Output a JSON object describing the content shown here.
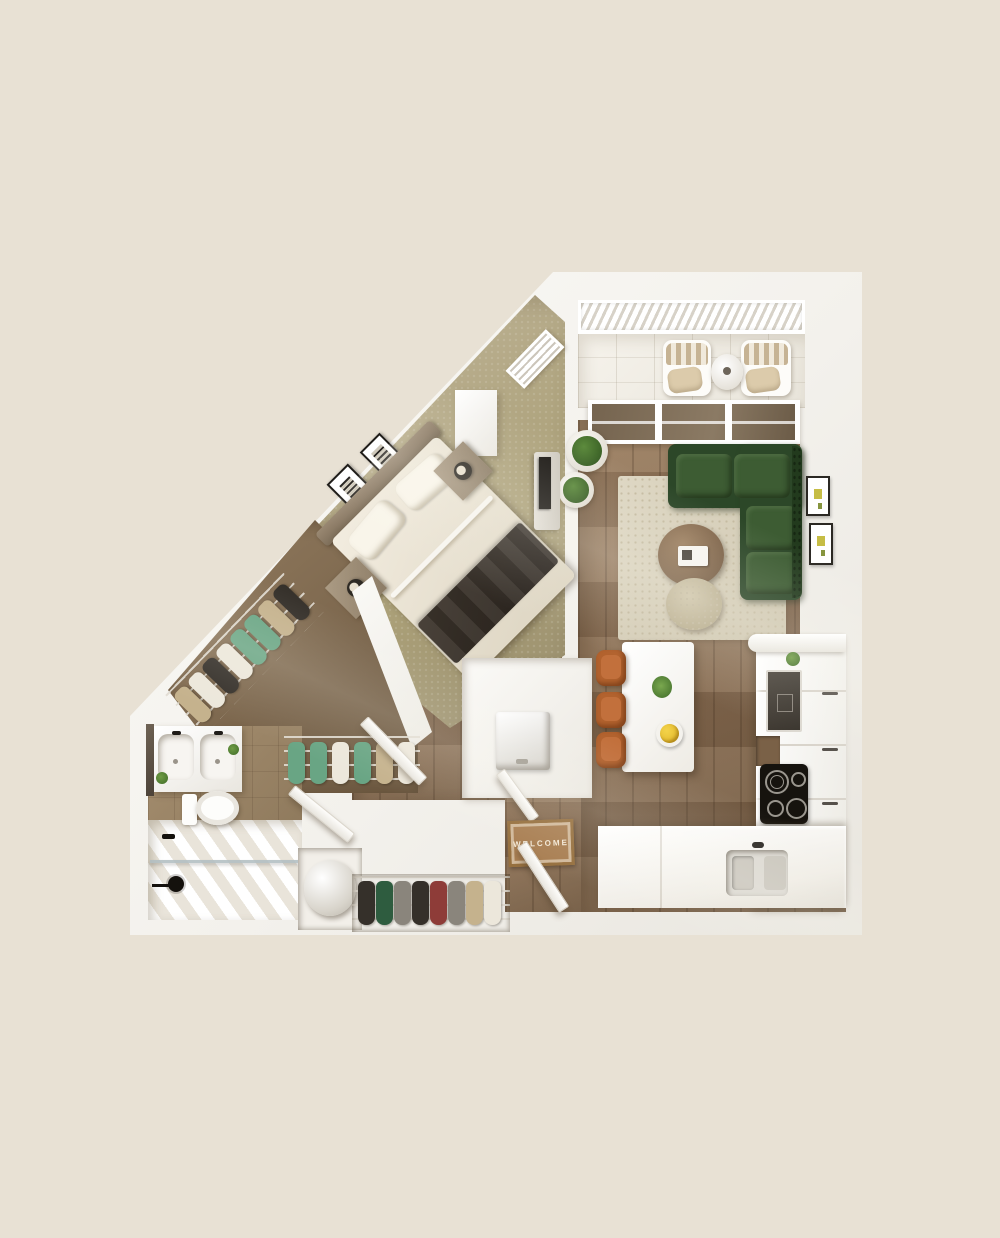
{
  "scene": {
    "kind": "3d-rendered-apartment-floor-plan",
    "view": "top-down"
  },
  "palette": {
    "bg": "#e8e1d4",
    "wall": "#f3f1ec",
    "wood": "#8d7257",
    "carpet": "#b0a57f",
    "closet-floor": "#7a654c",
    "bath-tile": "#a68f70",
    "rug-dot": "#c4baa0",
    "sofa": "#2c4728",
    "sofa-cushion": "#3d5c33",
    "dining-chair": "#b2622e",
    "glass": "#75644f",
    "appliance": "#36312a",
    "cooktop": "#16130e",
    "plant": "#3c6327",
    "throw": "#2d2620",
    "fruit": "#e0b427",
    "clothes-green": "#69a584",
    "clothes-dark": "#35302a",
    "clothes-tan": "#c5b28d",
    "clothes-maroon": "#8e3c38",
    "mat": "#a97f53",
    "mat-text": "#f3e9d7",
    "stripe": "#c6b394"
  },
  "entry": {
    "welcome_mat_text": "WELCOME",
    "features": [
      "welcome-mat",
      "entry-door"
    ]
  },
  "rooms": {
    "balcony": {
      "furniture": [
        "lounge-chair",
        "lounge-chair",
        "side-table"
      ],
      "features": [
        "railing",
        "sliding-glass-door",
        "tile-floor"
      ]
    },
    "living_room": {
      "furniture": [
        "green-sectional-sofa",
        "area-rug",
        "round-coffee-table",
        "ottoman-pouf",
        "potted-plant",
        "potted-plant",
        "wall-art-frame",
        "wall-art-frame"
      ],
      "floor": "wood-plank"
    },
    "dining_area": {
      "furniture": [
        "white-dining-table",
        "dining-chair",
        "dining-chair",
        "dining-chair",
        "flower-vase",
        "fruit-bowl"
      ],
      "floor": "wood-plank"
    },
    "kitchen": {
      "appliances": [
        "built-in-oven",
        "induction-cooktop",
        "double-sink",
        "cabinet-run",
        "counter",
        "open-shelf",
        "plant"
      ],
      "floor": "wood-plank"
    },
    "bedroom": {
      "furniture": [
        "bed-with-dark-throw",
        "headboard",
        "pillow",
        "pillow",
        "nightstand",
        "nightstand",
        "table-lamp",
        "table-lamp",
        "wall-art-frame",
        "wall-art-frame",
        "tv",
        "tv-stand",
        "window"
      ],
      "floor": "carpet"
    },
    "walk_in_closet": {
      "furniture": [
        "hanging-clothes-diagonal-rack",
        "hanging-clothes-bottom-rack",
        "wire-shelving"
      ],
      "floor": "carpet-brown"
    },
    "bathroom": {
      "fixtures": [
        "double-vanity",
        "sink",
        "sink",
        "mirror",
        "faucet",
        "faucet",
        "plant",
        "plant",
        "toilet",
        "walk-in-shower",
        "glass-partition",
        "shower-head",
        "shower-control"
      ]
    },
    "laundry_closet": {
      "appliances": [
        "washer"
      ]
    },
    "utility_closet": {
      "appliances": [
        "water-heater"
      ]
    },
    "coat_closet": {
      "furniture": [
        "hanging-clothes-rack"
      ]
    },
    "hallway": {
      "features": [
        "open-door",
        "open-door",
        "open-door",
        "open-door"
      ]
    }
  }
}
